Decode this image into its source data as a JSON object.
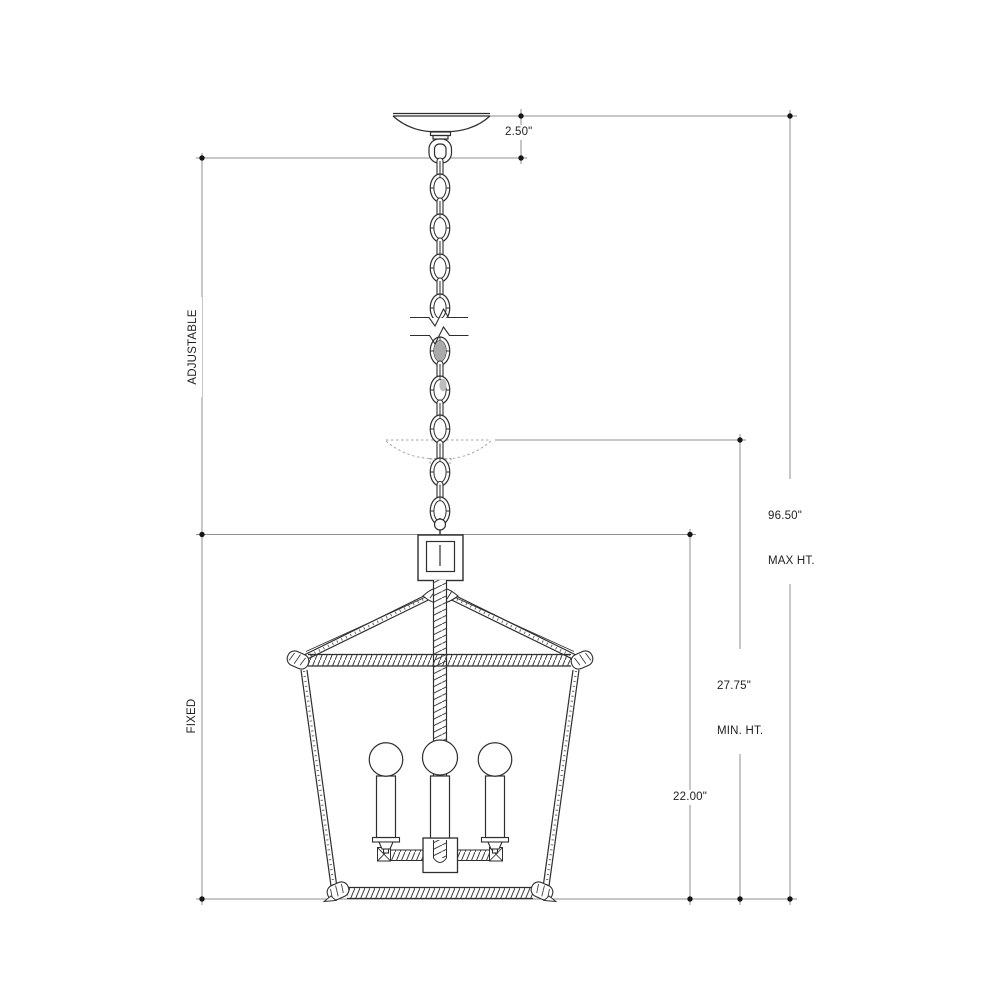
{
  "drawing": {
    "type": "technical-dimension-drawing",
    "subject": "lantern-chandelier-pendant",
    "background_color": "#ffffff",
    "line_color": "#2e2e2e",
    "dimension_line_color": "#8f8f8f",
    "text_color": "#1f1f1f"
  },
  "dimensions": {
    "canopy_drop": {
      "value": "2.50\""
    },
    "max_height": {
      "value": "96.50\"",
      "caption": "MAX HT."
    },
    "min_height": {
      "value": "27.75\"",
      "caption": "MIN. HT."
    },
    "fixed_height": {
      "value": "22.00\""
    },
    "adjustable_label": "ADJUSTABLE",
    "fixed_label": "FIXED"
  },
  "components": {
    "canopy": "ceiling canopy",
    "chain": "adjustable hanging chain with break symbol",
    "phantom_canopy": "canopy shown at minimum height (phantom line)",
    "cage": "tapered open lantern cage",
    "lamps": "3 candelabra lamps with round bulbs"
  }
}
